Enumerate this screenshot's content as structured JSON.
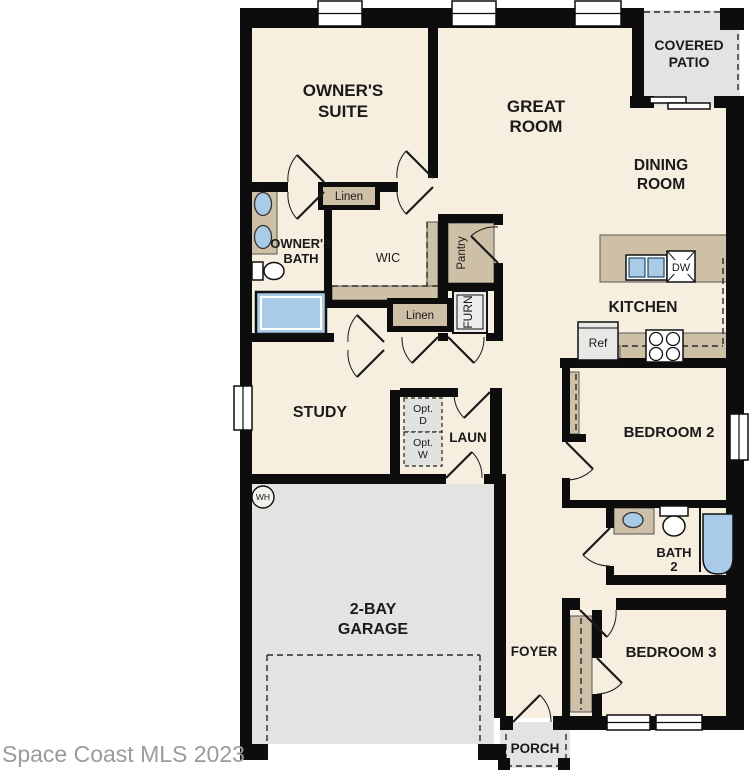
{
  "watermark": "Space Coast MLS 2023",
  "rooms": {
    "owners_suite": {
      "line1": "OWNER'S",
      "line2": "SUITE"
    },
    "great_room": {
      "line1": "GREAT",
      "line2": "ROOM"
    },
    "covered_patio": {
      "line1": "COVERED",
      "line2": "PATIO"
    },
    "dining_room": {
      "line1": "DINING",
      "line2": "ROOM"
    },
    "kitchen": {
      "label": "KITCHEN"
    },
    "owners_bath": {
      "line1": "OWNER'S",
      "line2": "BATH"
    },
    "wic": {
      "label": "WIC"
    },
    "pantry": {
      "label": "Pantry"
    },
    "study": {
      "label": "STUDY"
    },
    "laundry": {
      "label": "LAUN"
    },
    "garage": {
      "line1": "2-BAY",
      "line2": "GARAGE"
    },
    "bedroom2": {
      "label": "BEDROOM 2"
    },
    "bath2": {
      "line1": "BATH",
      "line2": "2"
    },
    "bedroom3": {
      "label": "BEDROOM 3"
    },
    "foyer": {
      "label": "FOYER"
    },
    "porch": {
      "label": "PORCH"
    }
  },
  "closets": {
    "linen_top": "Linen",
    "linen_bottom": "Linen"
  },
  "appliances": {
    "furnace": "FURN",
    "water_heater": "WH",
    "refrigerator": "Ref",
    "dishwasher": "DW",
    "opt_dryer": {
      "line1": "Opt.",
      "line2": "D"
    },
    "opt_washer": {
      "line1": "Opt.",
      "line2": "W"
    }
  },
  "colors": {
    "floor_cream": "#f6efe0",
    "counter_tan": "#cdc0a6",
    "floor_gray": "#e3e3e1",
    "fixture_blue": "#a9cbe7",
    "wall_black": "#0d0d0d",
    "watermark_gray": "#9b9b9b"
  }
}
